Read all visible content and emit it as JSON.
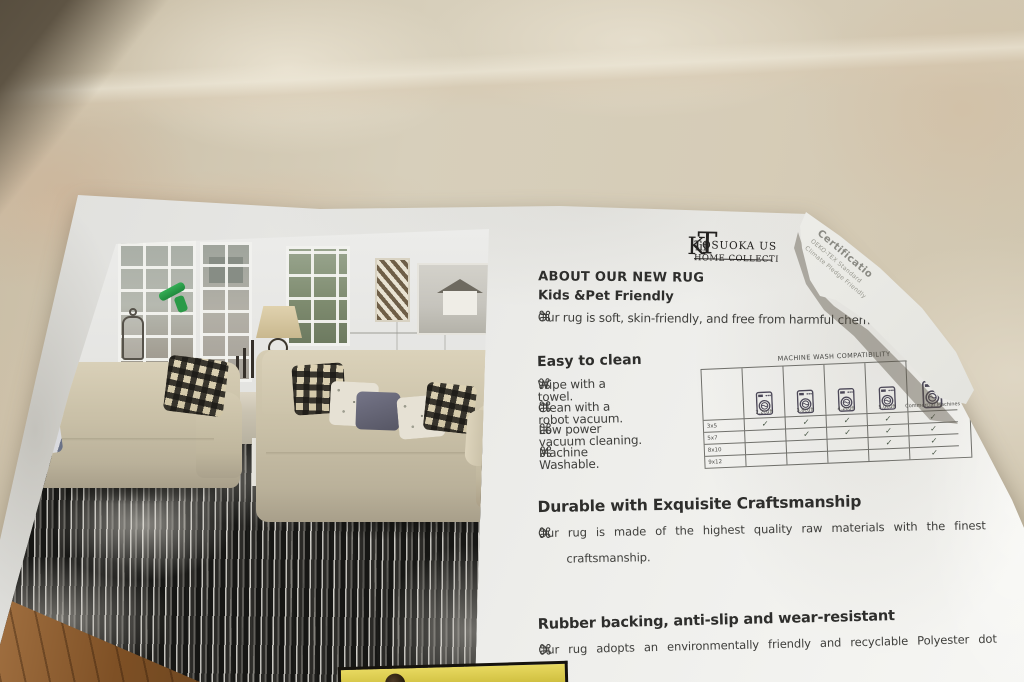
{
  "flyer": {
    "bullet_glyph": "⌘",
    "brand": {
      "name": "TOSUOKA US",
      "monogram_t": "T",
      "monogram_k": "K",
      "suffix": "lif",
      "tagline": "HOME COLLECTI"
    },
    "about": {
      "title": "ABOUT OUR NEW RUG",
      "subtitle": "Kids &Pet Friendly",
      "bullet": "Our rug is soft, skin-friendly, and free from harmful chemica"
    },
    "easy_clean": {
      "title": "Easy to clean",
      "bullets": [
        "Wipe with a towel.",
        "Clean with a robot vacuum.",
        "Low power vacuum cleaning.",
        "Machine Washable."
      ]
    },
    "wash_table": {
      "title": "MACHINE WASH COMPATIBILITY",
      "columns": [
        "2.2cuft",
        "3.8cuft",
        "4.2cuft",
        "5.0cuft",
        "Commercial Machines"
      ],
      "rows": [
        {
          "label": "3x5",
          "checks": [
            "✓",
            "✓",
            "✓",
            "✓",
            "✓"
          ]
        },
        {
          "label": "5x7",
          "checks": [
            "",
            "✓",
            "✓",
            "✓",
            "✓"
          ]
        },
        {
          "label": "8x10",
          "checks": [
            "",
            "",
            "",
            "✓",
            "✓"
          ]
        },
        {
          "label": "9x12",
          "checks": [
            "",
            "",
            "",
            "",
            "✓"
          ]
        }
      ]
    },
    "durable": {
      "title": "Durable with Exquisite Craftsmanship",
      "line1": "Our rug is made of the highest quality raw materials with the finest",
      "line2": "craftsmanship."
    },
    "rubber": {
      "title": "Rubber backing, anti-slip and wear-resistant",
      "line1": "Our rug adopts an environmentally friendly and recyclable Polyester dot"
    },
    "fold_note": {
      "line1": "Certificatio",
      "line2": "OEKO-TEX Standard",
      "line3": "Climate Pledge Friendly"
    }
  },
  "colors": {
    "card": "#ebebe8",
    "rug_background": "#d3c9b6",
    "tag_yellow": "#d7c74a",
    "check_mark": "#41503f",
    "ink": "#3a3a3a"
  }
}
